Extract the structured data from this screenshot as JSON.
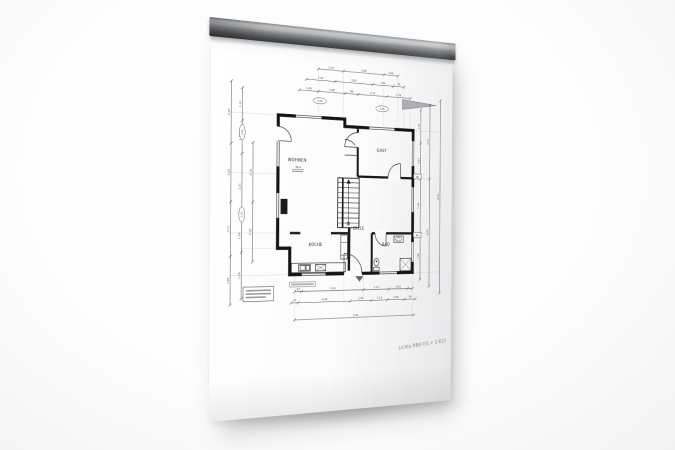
{
  "scene": {
    "description": "Photograph of an architectural ground-floor plan sheet clamped in an aluminum hanging rail",
    "background_color": "#f3f3f4",
    "paper_color": "#fcfcfd"
  },
  "rail": {
    "kind": "aluminum-clamp-rail",
    "highlight_color": "#caccce",
    "mid_color": "#84888b",
    "shadow_color": "#3c3f42"
  },
  "plan": {
    "ink_color": "#141414",
    "dim_color": "#555555",
    "rooms": [
      {
        "id": "wohnen",
        "label": "WOHNEN",
        "sub": "38,4",
        "x": 96,
        "y": 136
      },
      {
        "id": "gast",
        "label": "GAST",
        "x": 198,
        "y": 122
      },
      {
        "id": "diele",
        "label": "DIELE",
        "x": 170,
        "y": 208
      },
      {
        "id": "kueche",
        "label": "KÜCHE",
        "x": 118,
        "y": 226
      },
      {
        "id": "bad",
        "label": "BAD",
        "x": 204,
        "y": 226
      }
    ],
    "annotation": {
      "text": "Lichte RBH EG + 2.625",
      "x": 221,
      "y": 342,
      "rot": -5
    },
    "chains": [
      {
        "o": "h",
        "pos": 36,
        "a": 120,
        "b": 218,
        "ticks": [
          120,
          150,
          200,
          218
        ],
        "labels": [
          {
            "t": "1,76",
            "p": 135
          },
          {
            "t": "2,88",
            "p": 175
          },
          {
            "t": "1,01",
            "p": 209
          }
        ]
      },
      {
        "o": "h",
        "pos": 48,
        "a": 106,
        "b": 226,
        "ticks": [
          106,
          140,
          186,
          212,
          226
        ],
        "labels": [
          {
            "t": "2,01",
            "p": 123
          },
          {
            "t": "2,63",
            "p": 163
          },
          {
            "t": "1,51",
            "p": 199
          },
          {
            "t": "76",
            "p": 219
          }
        ]
      },
      {
        "o": "h",
        "pos": 60,
        "a": 98,
        "b": 234,
        "ticks": [
          98,
          120,
          152,
          168,
          204,
          234
        ],
        "labels": [
          {
            "t": "1,26",
            "p": 109
          },
          {
            "t": "1,88",
            "p": 136
          },
          {
            "t": "88",
            "p": 160
          },
          {
            "t": "2,13",
            "p": 186
          },
          {
            "t": "1,76",
            "p": 219
          }
        ]
      },
      {
        "o": "v",
        "pos": 22,
        "a": 56,
        "b": 286,
        "ticks": [
          56,
          120,
          180,
          236,
          286
        ],
        "labels": [
          {
            "t": "2,43",
            "p": 88
          },
          {
            "t": "2,26",
            "p": 150
          },
          {
            "t": "2,11",
            "p": 208
          },
          {
            "t": "1,89",
            "p": 261
          }
        ]
      },
      {
        "o": "v",
        "pos": 34,
        "a": 62,
        "b": 280,
        "ticks": [
          62,
          96,
          130,
          198,
          232,
          280
        ],
        "labels": [
          {
            "t": "1,11",
            "p": 79
          },
          {
            "t": "1,26",
            "p": 113
          },
          {
            "t": "2,51",
            "p": 164
          },
          {
            "t": "1,26",
            "p": 215
          },
          {
            "t": "1,76",
            "p": 256
          }
        ]
      },
      {
        "o": "v",
        "pos": 46,
        "a": 118,
        "b": 242,
        "ticks": [
          118,
          180,
          242
        ],
        "labels": [
          {
            "t": "2,18",
            "p": 149
          },
          {
            "t": "2,18",
            "p": 211
          }
        ]
      },
      {
        "o": "v",
        "pos": 248,
        "a": 72,
        "b": 264,
        "ticks": [
          72,
          110,
          150,
          212,
          264
        ],
        "labels": [
          {
            "t": "1,01",
            "p": 91
          },
          {
            "t": "1,51",
            "p": 130
          },
          {
            "t": "2,38",
            "p": 181
          },
          {
            "t": "1,88",
            "p": 238
          }
        ]
      },
      {
        "o": "v",
        "pos": 260,
        "a": 66,
        "b": 272,
        "ticks": [
          66,
          150,
          272
        ],
        "labels": [
          {
            "t": "3,13",
            "p": 108
          },
          {
            "t": "4,49",
            "p": 211
          }
        ]
      },
      {
        "o": "v",
        "pos": 274,
        "a": 60,
        "b": 280,
        "ticks": [
          60,
          280
        ],
        "labels": [
          {
            "t": "8,36",
            "p": 170
          }
        ]
      },
      {
        "o": "h",
        "pos": 274,
        "a": 94,
        "b": 238,
        "ticks": [
          94,
          102,
          176,
          208,
          232,
          238
        ],
        "labels": [
          {
            "t": "24",
            "p": 98
          },
          {
            "t": "5,00",
            "p": 139
          },
          {
            "t": "1,13",
            "p": 192
          },
          {
            "t": "2,42",
            "p": 220
          }
        ]
      },
      {
        "o": "h",
        "pos": 286,
        "a": 90,
        "b": 242,
        "ticks": [
          90,
          98,
          160,
          186,
          206,
          228,
          242
        ],
        "labels": [
          {
            "t": "17",
            "p": 94
          },
          {
            "t": "3,49",
            "p": 129
          },
          {
            "t": "1,51",
            "p": 173
          },
          {
            "t": "1,13",
            "p": 196
          },
          {
            "t": "1,26",
            "p": 217
          },
          {
            "t": "76",
            "p": 235
          }
        ]
      },
      {
        "o": "h",
        "pos": 304,
        "a": 94,
        "b": 240,
        "ticks": [
          94,
          240
        ],
        "labels": [
          {
            "t": "9,41",
            "p": 167
          }
        ]
      }
    ],
    "ovals": [
      {
        "t": "2,51",
        "cx": 122,
        "cy": 70,
        "rot": 0
      },
      {
        "t": "2,38",
        "cx": 198,
        "cy": 74,
        "rot": 0
      },
      {
        "t": "2,62",
        "cx": 34,
        "cy": 108,
        "rot": -90
      },
      {
        "t": "2,51",
        "cx": 34,
        "cy": 193,
        "rot": -90
      }
    ],
    "tags": [
      {
        "t": "86",
        "x": 244,
        "y": 148
      },
      {
        "t": "86",
        "x": 244,
        "y": 214
      }
    ]
  }
}
